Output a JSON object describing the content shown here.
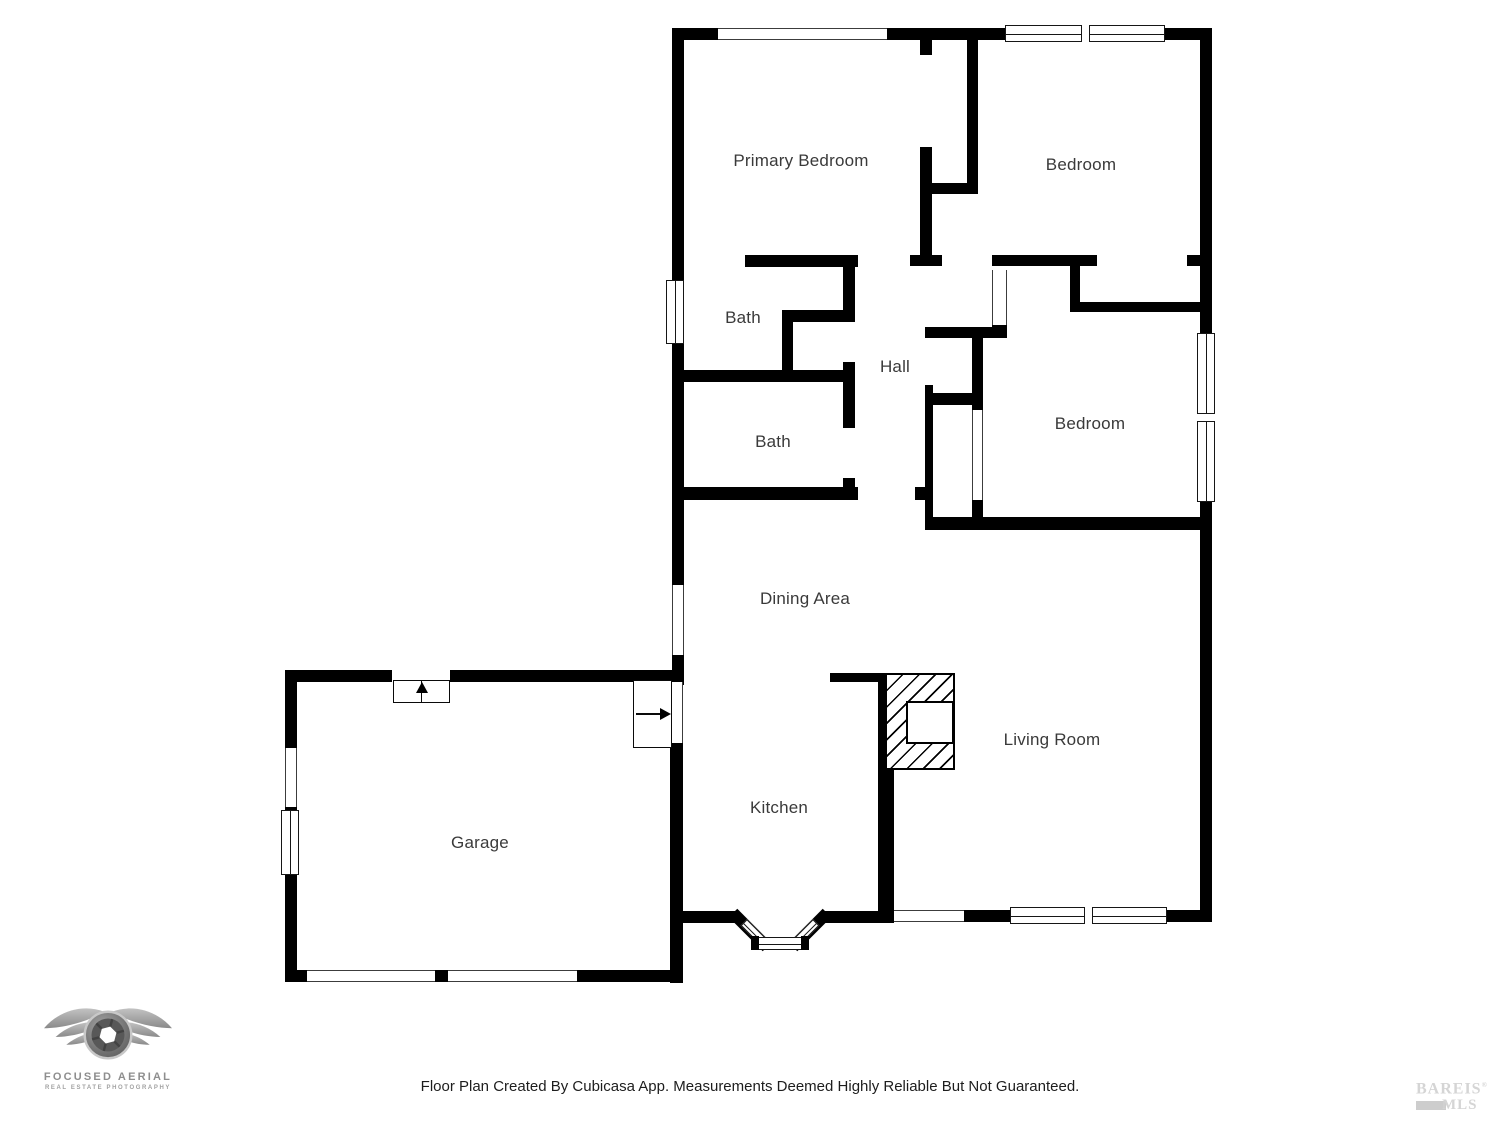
{
  "page": {
    "background": "#ffffff",
    "width": 1500,
    "height": 1125
  },
  "footer": {
    "text": "Floor Plan Created By Cubicasa App. Measurements Deemed Highly Reliable But Not Guaranteed."
  },
  "branding": {
    "photographer": {
      "name": "FOCUSED AERIAL",
      "tagline": "REAL ESTATE PHOTOGRAPHY"
    },
    "mls": {
      "name": "BAREIS",
      "reg": "®",
      "sub": "MLS"
    }
  },
  "floorplan": {
    "wall_color": "#000000",
    "label_color": "#3a3a3a",
    "rooms": [
      {
        "label": "Primary Bedroom",
        "x": 801,
        "y": 161
      },
      {
        "label": "Bedroom",
        "x": 1081,
        "y": 165
      },
      {
        "label": "Bath",
        "x": 743,
        "y": 318
      },
      {
        "label": "Hall",
        "x": 895,
        "y": 367
      },
      {
        "label": "Bath",
        "x": 773,
        "y": 442
      },
      {
        "label": "Bedroom",
        "x": 1090,
        "y": 424
      },
      {
        "label": "Dining Area",
        "x": 805,
        "y": 599
      },
      {
        "label": "Living Room",
        "x": 1052,
        "y": 740
      },
      {
        "label": "Kitchen",
        "x": 779,
        "y": 808
      },
      {
        "label": "Garage",
        "x": 480,
        "y": 843
      }
    ],
    "elements": [
      {
        "t": "wall",
        "r": [
          672,
          28,
          46,
          12
        ]
      },
      {
        "t": "wall",
        "r": [
          887,
          28,
          120,
          12
        ]
      },
      {
        "t": "wall",
        "r": [
          1163,
          28,
          49,
          12
        ]
      },
      {
        "t": "wall",
        "r": [
          672,
          28,
          12,
          254
        ]
      },
      {
        "t": "wall",
        "r": [
          672,
          342,
          12,
          243
        ]
      },
      {
        "t": "wall",
        "r": [
          672,
          655,
          12,
          30
        ]
      },
      {
        "t": "wall",
        "r": [
          1200,
          28,
          12,
          307
        ]
      },
      {
        "t": "wall",
        "r": [
          1200,
          500,
          12,
          422
        ]
      },
      {
        "t": "wall",
        "r": [
          920,
          40,
          12,
          15
        ]
      },
      {
        "t": "wall",
        "r": [
          920,
          147,
          12,
          108
        ]
      },
      {
        "t": "wall",
        "r": [
          910,
          255,
          32,
          11
        ]
      },
      {
        "t": "wall",
        "r": [
          967,
          40,
          11,
          153
        ]
      },
      {
        "t": "wall",
        "r": [
          927,
          183,
          51,
          11
        ]
      },
      {
        "t": "wall",
        "r": [
          745,
          255,
          113,
          12
        ]
      },
      {
        "t": "wall",
        "r": [
          992,
          255,
          105,
          11
        ]
      },
      {
        "t": "wall",
        "r": [
          1187,
          255,
          25,
          11
        ]
      },
      {
        "t": "wall",
        "r": [
          992,
          325,
          15,
          13
        ]
      },
      {
        "t": "wall",
        "r": [
          1070,
          260,
          10,
          52
        ]
      },
      {
        "t": "wall",
        "r": [
          1075,
          302,
          132,
          10
        ]
      },
      {
        "t": "wall",
        "r": [
          925,
          327,
          80,
          11
        ]
      },
      {
        "t": "wall",
        "r": [
          972,
          335,
          11,
          75
        ]
      },
      {
        "t": "wall",
        "r": [
          933,
          393,
          40,
          12
        ]
      },
      {
        "t": "wall",
        "r": [
          925,
          385,
          8,
          145
        ]
      },
      {
        "t": "wall",
        "r": [
          972,
          500,
          11,
          23
        ]
      },
      {
        "t": "wall",
        "r": [
          928,
          517,
          284,
          13
        ]
      },
      {
        "t": "wall",
        "r": [
          782,
          310,
          61,
          12
        ]
      },
      {
        "t": "wall",
        "r": [
          782,
          310,
          11,
          62
        ]
      },
      {
        "t": "wall",
        "r": [
          680,
          370,
          175,
          12
        ]
      },
      {
        "t": "wall",
        "r": [
          843,
          258,
          12,
          64
        ]
      },
      {
        "t": "wall",
        "r": [
          843,
          362,
          12,
          66
        ]
      },
      {
        "t": "wall",
        "r": [
          843,
          478,
          12,
          22
        ]
      },
      {
        "t": "wall",
        "r": [
          680,
          487,
          178,
          13
        ]
      },
      {
        "t": "wall",
        "r": [
          915,
          487,
          13,
          13
        ]
      },
      {
        "t": "wall",
        "r": [
          830,
          673,
          56,
          9
        ]
      },
      {
        "t": "wall",
        "r": [
          878,
          673,
          16,
          239
        ]
      },
      {
        "t": "wall",
        "r": [
          670,
          743,
          13,
          240
        ]
      },
      {
        "t": "wall",
        "r": [
          670,
          911,
          67,
          12
        ]
      },
      {
        "t": "wall",
        "r": [
          823,
          911,
          71,
          12
        ]
      },
      {
        "t": "wall",
        "r": [
          964,
          910,
          48,
          12
        ]
      },
      {
        "t": "wall",
        "r": [
          1165,
          910,
          47,
          12
        ]
      },
      {
        "t": "wall",
        "r": [
          285,
          670,
          107,
          12
        ]
      },
      {
        "t": "wall",
        "r": [
          450,
          670,
          233,
          12
        ]
      },
      {
        "t": "wall",
        "r": [
          285,
          670,
          12,
          78
        ]
      },
      {
        "t": "wall",
        "r": [
          285,
          807,
          12,
          8
        ]
      },
      {
        "t": "wall",
        "r": [
          285,
          873,
          12,
          100
        ]
      },
      {
        "t": "wall",
        "r": [
          285,
          970,
          22,
          12
        ]
      },
      {
        "t": "wall",
        "r": [
          435,
          970,
          13,
          12
        ]
      },
      {
        "t": "wall",
        "r": [
          577,
          970,
          106,
          12
        ]
      },
      {
        "t": "wall",
        "r": [
          726,
          924,
          48,
          12
        ],
        "rot": 45
      },
      {
        "t": "wall",
        "r": [
          786,
          924,
          48,
          12
        ],
        "rot": -45
      },
      {
        "t": "fire",
        "r": [
          885,
          673,
          70,
          97
        ]
      },
      {
        "t": "box",
        "r": [
          906,
          701,
          48,
          43
        ]
      },
      {
        "t": "win",
        "r": [
          718,
          28,
          169,
          12
        ]
      },
      {
        "t": "win",
        "r": [
          672,
          585,
          12,
          70
        ]
      },
      {
        "t": "win",
        "r": [
          285,
          748,
          12,
          59
        ]
      },
      {
        "t": "win",
        "r": [
          894,
          910,
          70,
          12
        ]
      },
      {
        "t": "win",
        "r": [
          670,
          682,
          13,
          61
        ]
      },
      {
        "t": "win",
        "r": [
          992,
          270,
          15,
          55
        ]
      },
      {
        "t": "win",
        "r": [
          972,
          410,
          11,
          90
        ]
      },
      {
        "t": "win",
        "r": [
          307,
          970,
          128,
          12
        ]
      },
      {
        "t": "win",
        "r": [
          448,
          970,
          129,
          12
        ]
      },
      {
        "t": "winf",
        "r": [
          1005,
          25,
          160,
          17
        ],
        "mull": true
      },
      {
        "t": "winf",
        "r": [
          666,
          280,
          18,
          64
        ]
      },
      {
        "t": "winf",
        "r": [
          1197,
          333,
          18,
          169
        ],
        "mull": true
      },
      {
        "t": "winf",
        "r": [
          1010,
          907,
          157,
          17
        ],
        "mull": true
      },
      {
        "t": "winf",
        "r": [
          281,
          810,
          18,
          65
        ]
      },
      {
        "t": "winf",
        "r": [
          740,
          927,
          26,
          9
        ],
        "rot": 45
      },
      {
        "t": "winf",
        "r": [
          794,
          927,
          26,
          9
        ],
        "rot": -45
      },
      {
        "t": "winf",
        "r": [
          756,
          937,
          48,
          13
        ]
      },
      {
        "t": "wall",
        "r": [
          751,
          936,
          8,
          14
        ]
      },
      {
        "t": "wall",
        "r": [
          801,
          936,
          8,
          14
        ]
      },
      {
        "t": "door",
        "r": [
          393,
          680,
          57,
          23
        ],
        "dir": "up"
      },
      {
        "t": "door",
        "r": [
          633,
          680,
          39,
          68
        ],
        "dir": "right"
      }
    ]
  }
}
